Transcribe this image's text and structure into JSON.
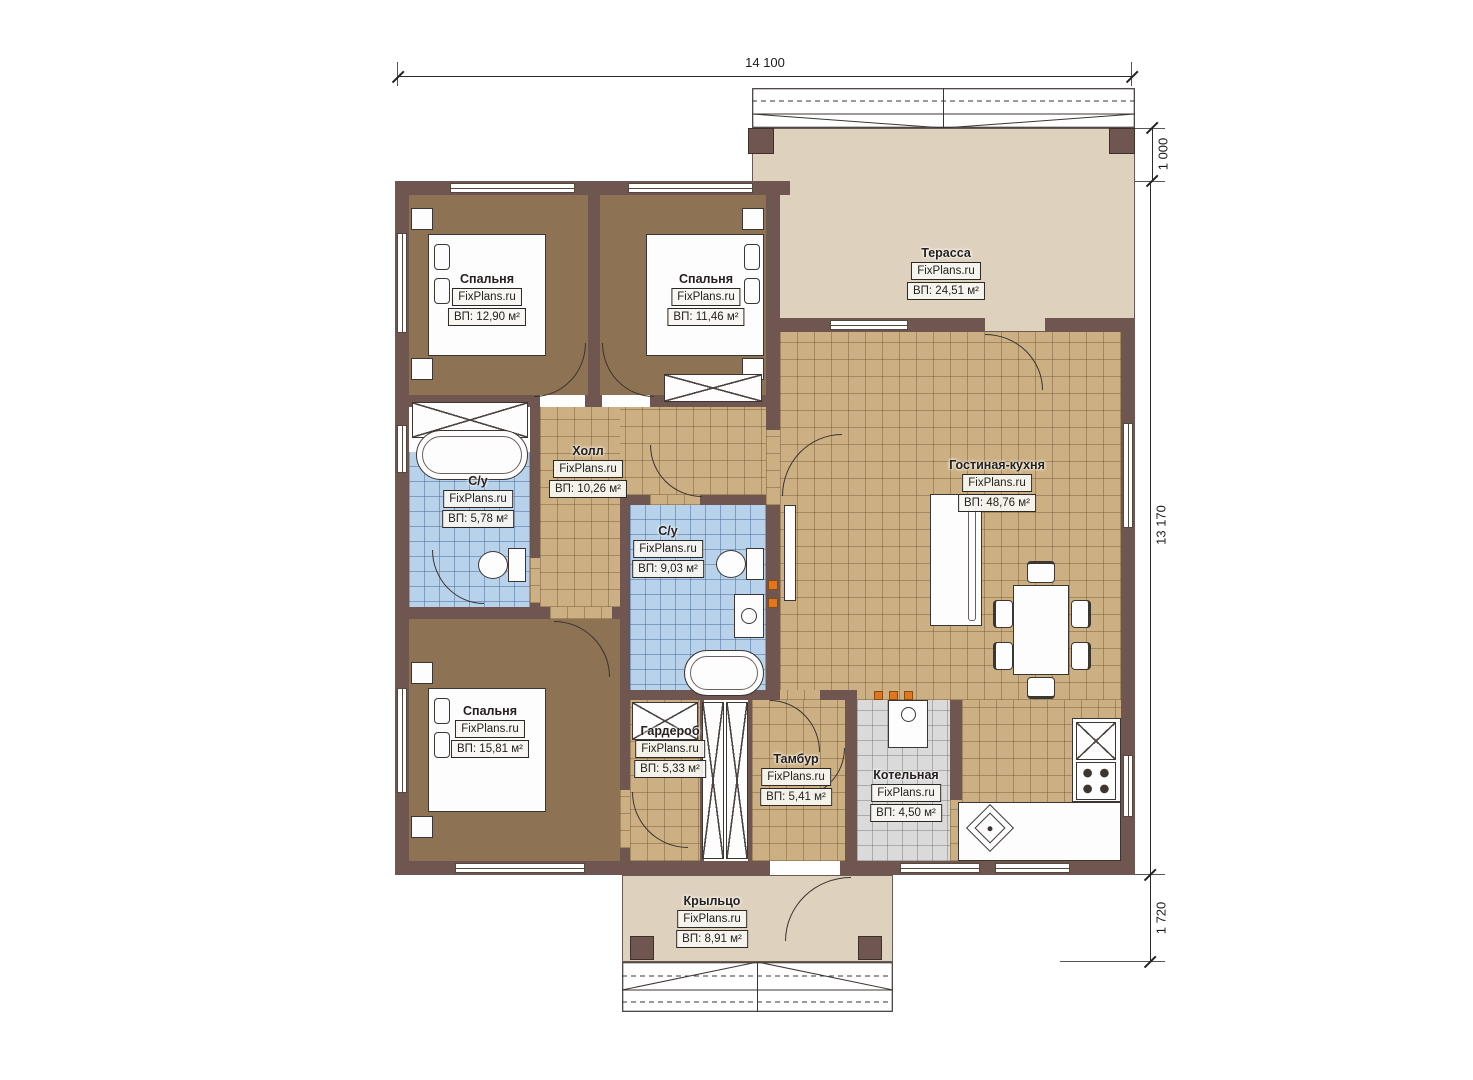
{
  "watermark": "FixPlans.ru",
  "dimensions": {
    "width_top": "14 100",
    "terrace_depth": "1 000",
    "height_right": "13 170",
    "porch_depth": "1 720"
  },
  "rooms": {
    "bedroom1": {
      "name": "Спальня",
      "area": "ВП: 12,90 м²"
    },
    "bedroom2": {
      "name": "Спальня",
      "area": "ВП: 11,46 м²"
    },
    "bedroom3": {
      "name": "Спальня",
      "area": "ВП: 15,81 м²"
    },
    "terrace": {
      "name": "Терасса",
      "area": "ВП: 24,51 м²"
    },
    "hall": {
      "name": "Холл",
      "area": "ВП: 10,26 м²"
    },
    "bath_small": {
      "name": "С/у",
      "area": "ВП: 5,78 м²"
    },
    "bath_main": {
      "name": "С/у",
      "area": "ВП: 9,03 м²"
    },
    "living_kitchen": {
      "name": "Гостиная-кухня",
      "area": "ВП: 48,76 м²"
    },
    "wardrobe": {
      "name": "Гардероб",
      "area": "ВП: 5,33 м²"
    },
    "vestibule": {
      "name": "Тамбур",
      "area": "ВП: 5,41 м²"
    },
    "boiler": {
      "name": "Котельная",
      "area": "ВП: 4,50 м²"
    },
    "porch": {
      "name": "Крыльцо",
      "area": "ВП: 8,91 м²"
    }
  },
  "colors": {
    "wall": "#6f5651",
    "bedroom_floor": "#8d7254",
    "tile_tan": "#ccb084",
    "tile_blue": "#b7d2ea",
    "tile_gray": "#dadada",
    "deck": "#ded2bf",
    "accent_orange": "#e0761f"
  }
}
